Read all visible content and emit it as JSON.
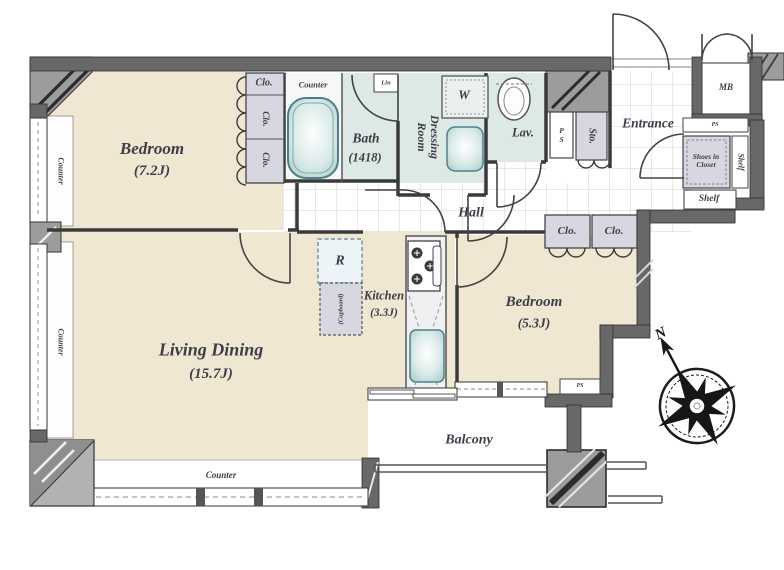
{
  "rooms": {
    "bedroom_1": {
      "name": "Bedroom",
      "area": "(7.2J)"
    },
    "bedroom_2": {
      "name": "Bedroom",
      "area": "(5.3J)"
    },
    "living_dining": {
      "name": "Living Dining",
      "area": "(15.7J)"
    },
    "kitchen": {
      "name": "Kitchen",
      "area": "(3.3J)"
    },
    "bath": {
      "name": "Bath",
      "area": "(1418)"
    },
    "dressing_room": {
      "line1": "Dressing",
      "line2": "Room"
    },
    "hall": {
      "name": "Hall"
    },
    "entrance": {
      "name": "Entrance"
    },
    "balcony": {
      "name": "Balcony"
    },
    "lavatory": {
      "name": "Lav."
    }
  },
  "labels": {
    "closet": "Clo.",
    "counter": "Counter",
    "storage": "Sto.",
    "linen": "Lin",
    "washer": "W",
    "refrigerator": "R",
    "cupboard": "(Cupboard)",
    "meter_box": "MB",
    "pipe_space": "PS",
    "shoes_closet_line1": "Shoes in",
    "shoes_closet_line2": "Closet",
    "shelf": "Shelf"
  },
  "compass": {
    "north": "N"
  },
  "colors": {
    "floor_beige": "#f0e7d2",
    "wet_room_teal": "#dde9e5",
    "closet_lavender": "#d7d7e1",
    "wall_gray": "#666666",
    "corner_hatch_gray": "#9c9c9c",
    "fixture_teal": "#bcd9d7",
    "label_text": "#3e3e48"
  }
}
